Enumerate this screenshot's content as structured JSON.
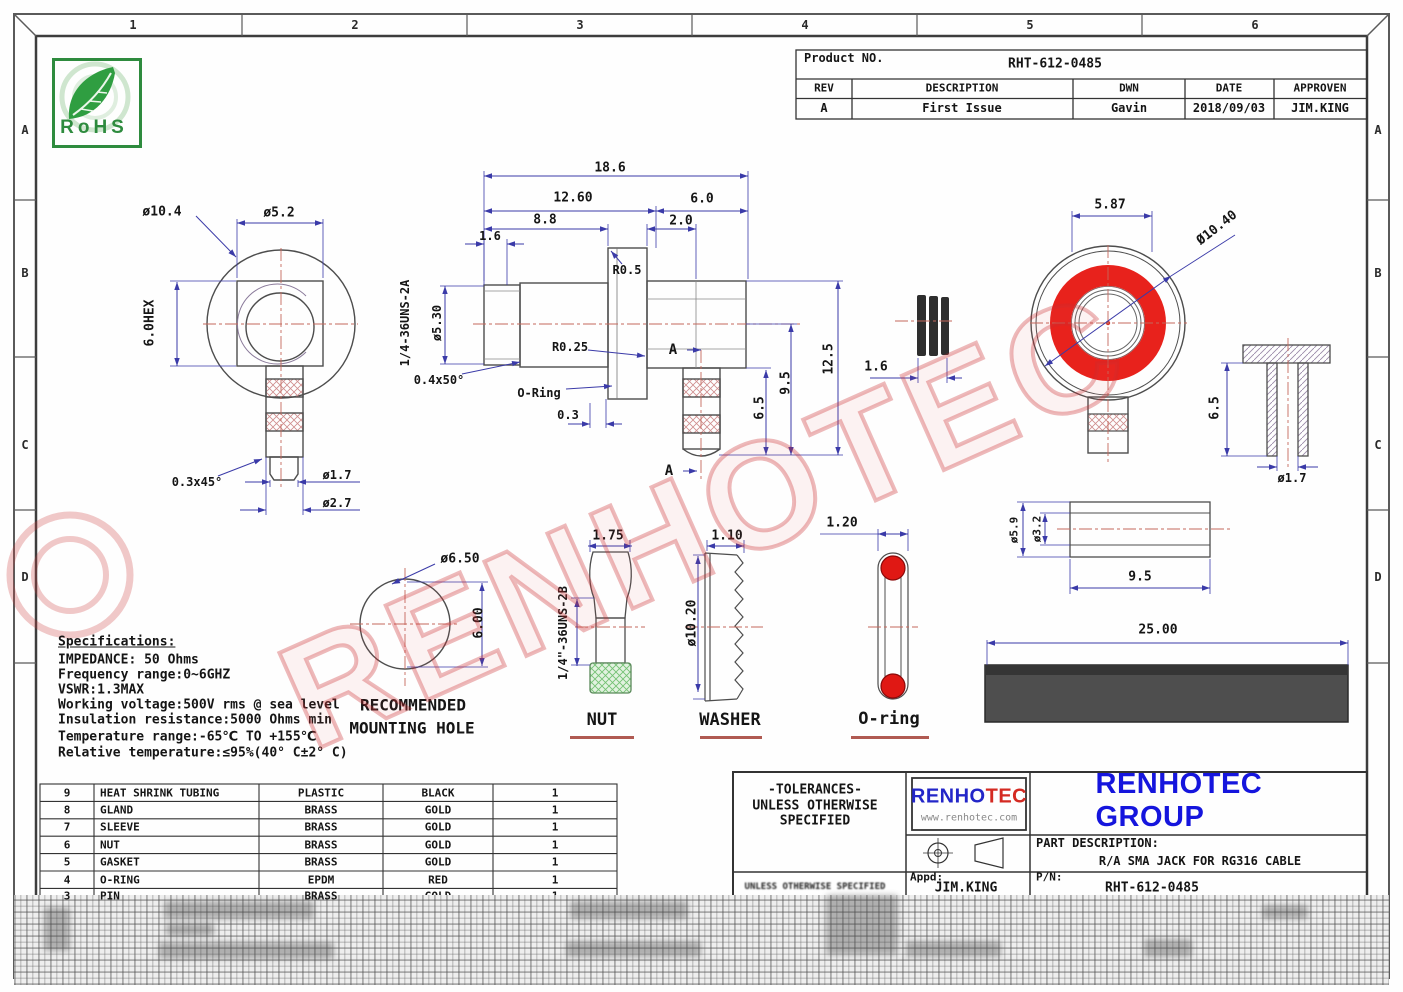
{
  "zones": {
    "cols": [
      "1",
      "2",
      "3",
      "4",
      "5",
      "6"
    ],
    "rows": [
      "A",
      "B",
      "C",
      "D"
    ]
  },
  "rohs": {
    "label": "RoHS"
  },
  "watermark": "RENHOTEC",
  "colors": {
    "accent_red": "#e8221c",
    "dim_blue": "#3a3aa8",
    "center_red": "#c4685c",
    "logo_blue": "#2326c8",
    "logo_red": "#d42a22",
    "company_blue": "#1515dd",
    "rohs_green": "#2e8b3e",
    "oring_red": "#e01814"
  },
  "product_table": {
    "label": "Product NO.",
    "number": "RHT-612-0485",
    "headers": [
      "REV",
      "DESCRIPTION",
      "DWN",
      "DATE",
      "APPROVEN"
    ],
    "row": [
      "A",
      "First Issue",
      "Gavin",
      "2018/09/03",
      "JIM.KING"
    ]
  },
  "side_view": {
    "dia_body": "ø10.4",
    "dia_square": "ø5.2",
    "hex": "6.0HEX",
    "chamfer": "0.3x45°",
    "dia_tip": "ø1.7",
    "dia_stem": "ø2.7"
  },
  "section_view": {
    "len_total": "18.6",
    "len_front": "12.60",
    "len_rear": "6.0",
    "len_body": "8.8",
    "len_flange": "2.0",
    "len_step": "1.6",
    "radius_flange": "R0.5",
    "dia_thread": "ø5.30",
    "thread": "1/4-36UNS-2A",
    "radius_groove": "R0.25",
    "chamfer": "0.4x50°",
    "oring_label": "O-Ring",
    "len_groove": "0.3",
    "section_mark": "A",
    "len_stem": "6.5",
    "len_mid": "9.5",
    "len_overall": "12.5"
  },
  "gasket_view": {
    "width": "1.6"
  },
  "face_view": {
    "across_flats": "5.87",
    "dia_outer": "Ø10.40"
  },
  "pin_view": {
    "height": "6.5",
    "dia": "ø1.7"
  },
  "sleeve_view": {
    "dia_outer": "ø5.9",
    "dia_inner": "ø3.2",
    "length": "9.5"
  },
  "mounting_hole": {
    "dia": "ø6.50",
    "height": "6.00",
    "caption_line1": "RECOMMENDED",
    "caption_line2": "MOUNTING HOLE"
  },
  "nut_view": {
    "width": "1.75",
    "thread": "1/4\"-36UNS-2B",
    "caption": "NUT"
  },
  "washer_view": {
    "width": "1.10",
    "dia": "ø10.20",
    "caption": "WASHER"
  },
  "oring_view": {
    "cs": "1.20",
    "caption": "O-ring"
  },
  "tubing_view": {
    "length": "25.00"
  },
  "specs": {
    "title": "Specifications:",
    "lines": [
      "IMPEDANCE: 50 Ohms",
      "Frequency range:0~6GHZ",
      "VSWR:1.3MAX",
      "Working voltage:500V rms @ sea level",
      "Insulation resistance:5000 Ohms min",
      "Temperature range:-65℃ TO +155℃",
      "Relative temperature:≤95%(40° C±2° C)"
    ]
  },
  "parts_table": {
    "rows": [
      [
        "9",
        "HEAT SHRINK TUBING",
        "PLASTIC",
        "BLACK",
        "1"
      ],
      [
        "8",
        "GLAND",
        "BRASS",
        "GOLD",
        "1"
      ],
      [
        "7",
        "SLEEVE",
        "BRASS",
        "GOLD",
        "1"
      ],
      [
        "6",
        "NUT",
        "BRASS",
        "GOLD",
        "1"
      ],
      [
        "5",
        "GASKET",
        "BRASS",
        "GOLD",
        "1"
      ],
      [
        "4",
        "O-RING",
        "EPDM",
        "RED",
        "1"
      ],
      [
        "3",
        "PIN",
        "BRASS",
        "GOLD",
        "1"
      ]
    ]
  },
  "title_block": {
    "tolerances": [
      "-TOLERANCES-",
      "UNLESS OTHERWISE",
      "SPECIFIED"
    ],
    "tolerances_small": "UNLESS OTHERWISE SPECIFIED",
    "logo_text_1": "RENHO",
    "logo_text_2": "TEC",
    "logo_url": "www.renhotec.com",
    "company": "RENHOTEC GROUP",
    "part_desc_label": "PART DESCRIPTION:",
    "part_desc": "R/A SMA JACK FOR RG316 CABLE",
    "appd_label": "Appd:",
    "appd_value": "JIM.KING",
    "pn_label": "P/N:",
    "pn_value": "RHT-612-0485"
  }
}
